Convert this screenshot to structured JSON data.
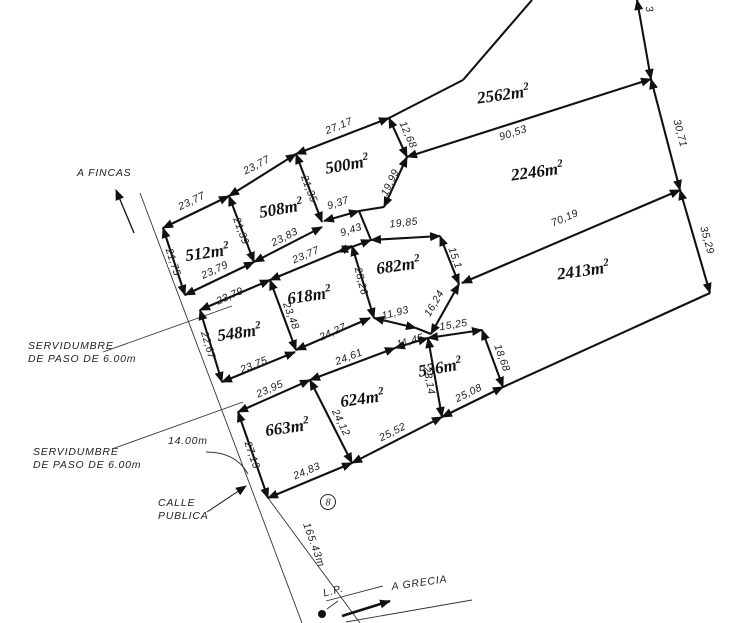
{
  "plan": {
    "area_unit": "m",
    "area_sup": "2",
    "lot_circle_number": "8",
    "parcels": [
      {
        "name": "parcel-2562",
        "value": "2562",
        "x": 504,
        "y": 100,
        "rot": -8
      },
      {
        "name": "parcel-2246",
        "value": "2246",
        "x": 538,
        "y": 177,
        "rot": -8
      },
      {
        "name": "parcel-2413",
        "value": "2413",
        "x": 584,
        "y": 276,
        "rot": -8
      },
      {
        "name": "parcel-500",
        "value": "500",
        "x": 348,
        "y": 170,
        "rot": -10
      },
      {
        "name": "parcel-508",
        "value": "508",
        "x": 282,
        "y": 214,
        "rot": -10
      },
      {
        "name": "parcel-512",
        "value": "512",
        "x": 208,
        "y": 258,
        "rot": -8
      },
      {
        "name": "parcel-682",
        "value": "682",
        "x": 399,
        "y": 271,
        "rot": -8
      },
      {
        "name": "parcel-618",
        "value": "618",
        "x": 310,
        "y": 301,
        "rot": -8
      },
      {
        "name": "parcel-548",
        "value": "548",
        "x": 240,
        "y": 338,
        "rot": -8
      },
      {
        "name": "parcel-663",
        "value": "663",
        "x": 288,
        "y": 433,
        "rot": -8
      },
      {
        "name": "parcel-624",
        "value": "624",
        "x": 363,
        "y": 404,
        "rot": -8
      },
      {
        "name": "parcel-536",
        "value": "536",
        "x": 441,
        "y": 373,
        "rot": -10
      }
    ],
    "edges": [
      {
        "x1": 163,
        "y1": 228,
        "x2": 229,
        "y2": 196,
        "label": "23,77",
        "lx": 193,
        "ly": 204,
        "lrot": -26
      },
      {
        "x1": 229,
        "y1": 196,
        "x2": 296,
        "y2": 154,
        "label": "23,77",
        "lx": 258,
        "ly": 168,
        "lrot": -28
      },
      {
        "x1": 296,
        "y1": 154,
        "x2": 389,
        "y2": 118,
        "label": "27,17",
        "lx": 340,
        "ly": 129,
        "lrot": -22
      },
      {
        "x1": 389,
        "y1": 118,
        "x2": 407,
        "y2": 157,
        "label": "12,68",
        "lx": 405,
        "ly": 136,
        "lrot": 66
      },
      {
        "x1": 407,
        "y1": 157,
        "x2": 384,
        "y2": 207,
        "label": "19,99",
        "lx": 393,
        "ly": 184,
        "lrot": -64
      },
      {
        "x1": 163,
        "y1": 228,
        "x2": 185,
        "y2": 295,
        "label": "21,75",
        "lx": 170,
        "ly": 263,
        "lrot": 72
      },
      {
        "x1": 229,
        "y1": 196,
        "x2": 254,
        "y2": 262,
        "label": "21,39",
        "lx": 238,
        "ly": 232,
        "lrot": 70
      },
      {
        "x1": 296,
        "y1": 154,
        "x2": 322,
        "y2": 222,
        "label": "21,35",
        "lx": 306,
        "ly": 190,
        "lrot": 69
      },
      {
        "x1": 185,
        "y1": 295,
        "x2": 254,
        "y2": 262,
        "label": "23,79",
        "lx": 216,
        "ly": 273,
        "lrot": -25
      },
      {
        "x1": 254,
        "y1": 262,
        "x2": 322,
        "y2": 227,
        "label": "23,83",
        "lx": 286,
        "ly": 240,
        "lrot": -27
      },
      {
        "x1": 324,
        "y1": 221,
        "x2": 359,
        "y2": 211,
        "label": "9,37",
        "lx": 339,
        "ly": 206,
        "lrot": -18
      },
      {
        "x1": 338,
        "y1": 252,
        "x2": 371,
        "y2": 240,
        "label": "9,43",
        "lx": 352,
        "ly": 233,
        "lrot": -18
      },
      {
        "x1": 200,
        "y1": 310,
        "x2": 270,
        "y2": 280,
        "label": "23,79",
        "lx": 231,
        "ly": 299,
        "lrot": -24
      },
      {
        "x1": 270,
        "y1": 280,
        "x2": 352,
        "y2": 246,
        "label": "23,77",
        "lx": 307,
        "ly": 258,
        "lrot": -23
      },
      {
        "x1": 200,
        "y1": 310,
        "x2": 222,
        "y2": 382,
        "label": "22,67",
        "lx": 205,
        "ly": 346,
        "lrot": 73
      },
      {
        "x1": 270,
        "y1": 280,
        "x2": 296,
        "y2": 350,
        "label": "23,48",
        "lx": 288,
        "ly": 317,
        "lrot": 69
      },
      {
        "x1": 352,
        "y1": 246,
        "x2": 374,
        "y2": 318,
        "label": "28,26",
        "lx": 358,
        "ly": 282,
        "lrot": 76
      },
      {
        "x1": 222,
        "y1": 382,
        "x2": 295,
        "y2": 352,
        "label": "23,75",
        "lx": 255,
        "ly": 368,
        "lrot": -22
      },
      {
        "x1": 296,
        "y1": 350,
        "x2": 370,
        "y2": 318,
        "label": "24,27",
        "lx": 334,
        "ly": 335,
        "lrot": -24
      },
      {
        "x1": 371,
        "y1": 240,
        "x2": 440,
        "y2": 236,
        "label": "19,85",
        "lx": 404,
        "ly": 226,
        "lrot": -6
      },
      {
        "x1": 440,
        "y1": 236,
        "x2": 459,
        "y2": 284,
        "label": "15,1",
        "lx": 452,
        "ly": 259,
        "lrot": 70
      },
      {
        "x1": 459,
        "y1": 284,
        "x2": 431,
        "y2": 334,
        "label": "16,24",
        "lx": 437,
        "ly": 305,
        "lrot": -60
      },
      {
        "x1": 374,
        "y1": 318,
        "x2": 416,
        "y2": 328,
        "label": "11,93",
        "lx": 396,
        "ly": 316,
        "lrot": -14
      },
      {
        "x1": 395,
        "y1": 348,
        "x2": 428,
        "y2": 338,
        "label": "11,45",
        "lx": 411,
        "ly": 344,
        "lrot": -16
      },
      {
        "x1": 428,
        "y1": 338,
        "x2": 482,
        "y2": 330,
        "label": "15,25",
        "lx": 454,
        "ly": 328,
        "lrot": -9
      },
      {
        "x1": 238,
        "y1": 412,
        "x2": 310,
        "y2": 380,
        "label": "23,95",
        "lx": 271,
        "ly": 392,
        "lrot": -24
      },
      {
        "x1": 310,
        "y1": 380,
        "x2": 395,
        "y2": 348,
        "label": "24,61",
        "lx": 350,
        "ly": 360,
        "lrot": -21
      },
      {
        "x1": 238,
        "y1": 412,
        "x2": 268,
        "y2": 498,
        "label": "27,13",
        "lx": 249,
        "ly": 456,
        "lrot": 71
      },
      {
        "x1": 268,
        "y1": 498,
        "x2": 352,
        "y2": 463,
        "label": "24,83",
        "lx": 308,
        "ly": 474,
        "lrot": -23
      },
      {
        "x1": 310,
        "y1": 380,
        "x2": 352,
        "y2": 463,
        "label": "24,12",
        "lx": 338,
        "ly": 424,
        "lrot": 64
      },
      {
        "x1": 352,
        "y1": 463,
        "x2": 442,
        "y2": 417,
        "label": "25,52",
        "lx": 394,
        "ly": 435,
        "lrot": -27
      },
      {
        "x1": 428,
        "y1": 338,
        "x2": 442,
        "y2": 417,
        "label": "23,14",
        "lx": 426,
        "ly": 381,
        "lrot": 80
      },
      {
        "x1": 442,
        "y1": 417,
        "x2": 503,
        "y2": 387,
        "label": "25,08",
        "lx": 470,
        "ly": 396,
        "lrot": -26
      },
      {
        "x1": 482,
        "y1": 330,
        "x2": 503,
        "y2": 387,
        "label": "18,68",
        "lx": 499,
        "ly": 359,
        "lrot": 70
      },
      {
        "x1": 407,
        "y1": 157,
        "x2": 651,
        "y2": 79,
        "label": "90,53",
        "lx": 514,
        "ly": 136,
        "lrot": -18
      },
      {
        "x1": 651,
        "y1": 79,
        "x2": 680,
        "y2": 190,
        "label": "30,71",
        "lx": 677,
        "ly": 134,
        "lrot": 75
      },
      {
        "x1": 680,
        "y1": 190,
        "x2": 710,
        "y2": 293,
        "label": "35,29",
        "lx": 704,
        "ly": 241,
        "lrot": 74
      },
      {
        "x1": 462,
        "y1": 283,
        "x2": 680,
        "y2": 190,
        "label": "70,19",
        "lx": 566,
        "ly": 221,
        "lrot": -23
      },
      {
        "x1": 637,
        "y1": 0,
        "x2": 651,
        "y2": 79,
        "label": "3",
        "lx": 646,
        "ly": 10,
        "lrot": 75
      }
    ],
    "plain_edges": [
      {
        "x1": 532,
        "y1": 0,
        "x2": 463,
        "y2": 80
      },
      {
        "x1": 463,
        "y1": 80,
        "x2": 389,
        "y2": 118
      },
      {
        "x1": 710,
        "y1": 293,
        "x2": 503,
        "y2": 387
      },
      {
        "x1": 359,
        "y1": 211,
        "x2": 384,
        "y2": 207
      },
      {
        "x1": 359,
        "y1": 211,
        "x2": 371,
        "y2": 240
      },
      {
        "x1": 416,
        "y1": 328,
        "x2": 431,
        "y2": 334
      }
    ],
    "thin_lines": [
      {
        "name": "calle-left-edge",
        "x1": 140,
        "y1": 193,
        "x2": 302,
        "y2": 623
      },
      {
        "name": "calle-right-edge",
        "x1": 268,
        "y1": 498,
        "x2": 360,
        "y2": 623
      },
      {
        "name": "grecia-road-upper",
        "x1": 326,
        "y1": 601,
        "x2": 383,
        "y2": 586
      },
      {
        "name": "grecia-road-lower",
        "x1": 346,
        "y1": 622,
        "x2": 472,
        "y2": 600
      },
      {
        "name": "servidumbre-1-leader",
        "x1": 103,
        "y1": 352,
        "x2": 232,
        "y2": 306
      },
      {
        "name": "servidumbre-2-leader",
        "x1": 112,
        "y1": 449,
        "x2": 243,
        "y2": 402
      },
      {
        "name": "lp-leader",
        "x1": 327,
        "y1": 609,
        "x2": 338,
        "y2": 601
      }
    ],
    "arrow_lines": [
      {
        "name": "a-fincas-arrow",
        "x1": 134,
        "y1": 233,
        "x2": 116,
        "y2": 190,
        "w": 1.3
      },
      {
        "name": "calle-publica-leader-arrow",
        "x1": 207,
        "y1": 512,
        "x2": 246,
        "y2": 486,
        "w": 1
      },
      {
        "name": "a-grecia-arrow",
        "x1": 342,
        "y1": 616,
        "x2": 390,
        "y2": 601,
        "w": 2.6
      }
    ],
    "curves": [
      {
        "name": "leader-14m",
        "d": "M 206,452 Q 236,452 248,474"
      }
    ],
    "annotations": [
      {
        "name": "label-a-fincas",
        "lines": [
          "A FINCAS"
        ],
        "x": 77,
        "y": 176,
        "rot": 0,
        "size": 11
      },
      {
        "name": "label-servidumbre-1",
        "lines": [
          "SERVIDUMBRE",
          "DE  PASO  DE  6.00m"
        ],
        "x": 28,
        "y": 349,
        "rot": 0,
        "size": 10.5
      },
      {
        "name": "label-servidumbre-2",
        "lines": [
          "SERVIDUMBRE",
          "DE  PASO  DE  6.00m"
        ],
        "x": 33,
        "y": 455,
        "rot": 0,
        "size": 10.5
      },
      {
        "name": "label-14m",
        "lines": [
          "14.00m"
        ],
        "x": 168,
        "y": 444,
        "rot": 0,
        "size": 10.5
      },
      {
        "name": "label-calle-publica",
        "lines": [
          "CALLE",
          "PUBLICA"
        ],
        "x": 158,
        "y": 506,
        "rot": 0,
        "size": 11
      },
      {
        "name": "label-165m",
        "lines": [
          "165.43m"
        ],
        "x": 311,
        "y": 546,
        "rot": 70,
        "size": 11,
        "anchor": "middle"
      },
      {
        "name": "label-lp",
        "lines": [
          "L.P."
        ],
        "x": 334,
        "y": 594,
        "rot": -15,
        "size": 11,
        "anchor": "middle"
      },
      {
        "name": "label-a-grecia",
        "lines": [
          "A GRECIA"
        ],
        "x": 392,
        "y": 590,
        "rot": -8,
        "size": 11
      }
    ],
    "lot_circle": {
      "cx": 328,
      "cy": 502,
      "r": 7.5
    },
    "lp_dot": {
      "cx": 322,
      "cy": 614,
      "r": 4
    },
    "ink": "#111111"
  }
}
